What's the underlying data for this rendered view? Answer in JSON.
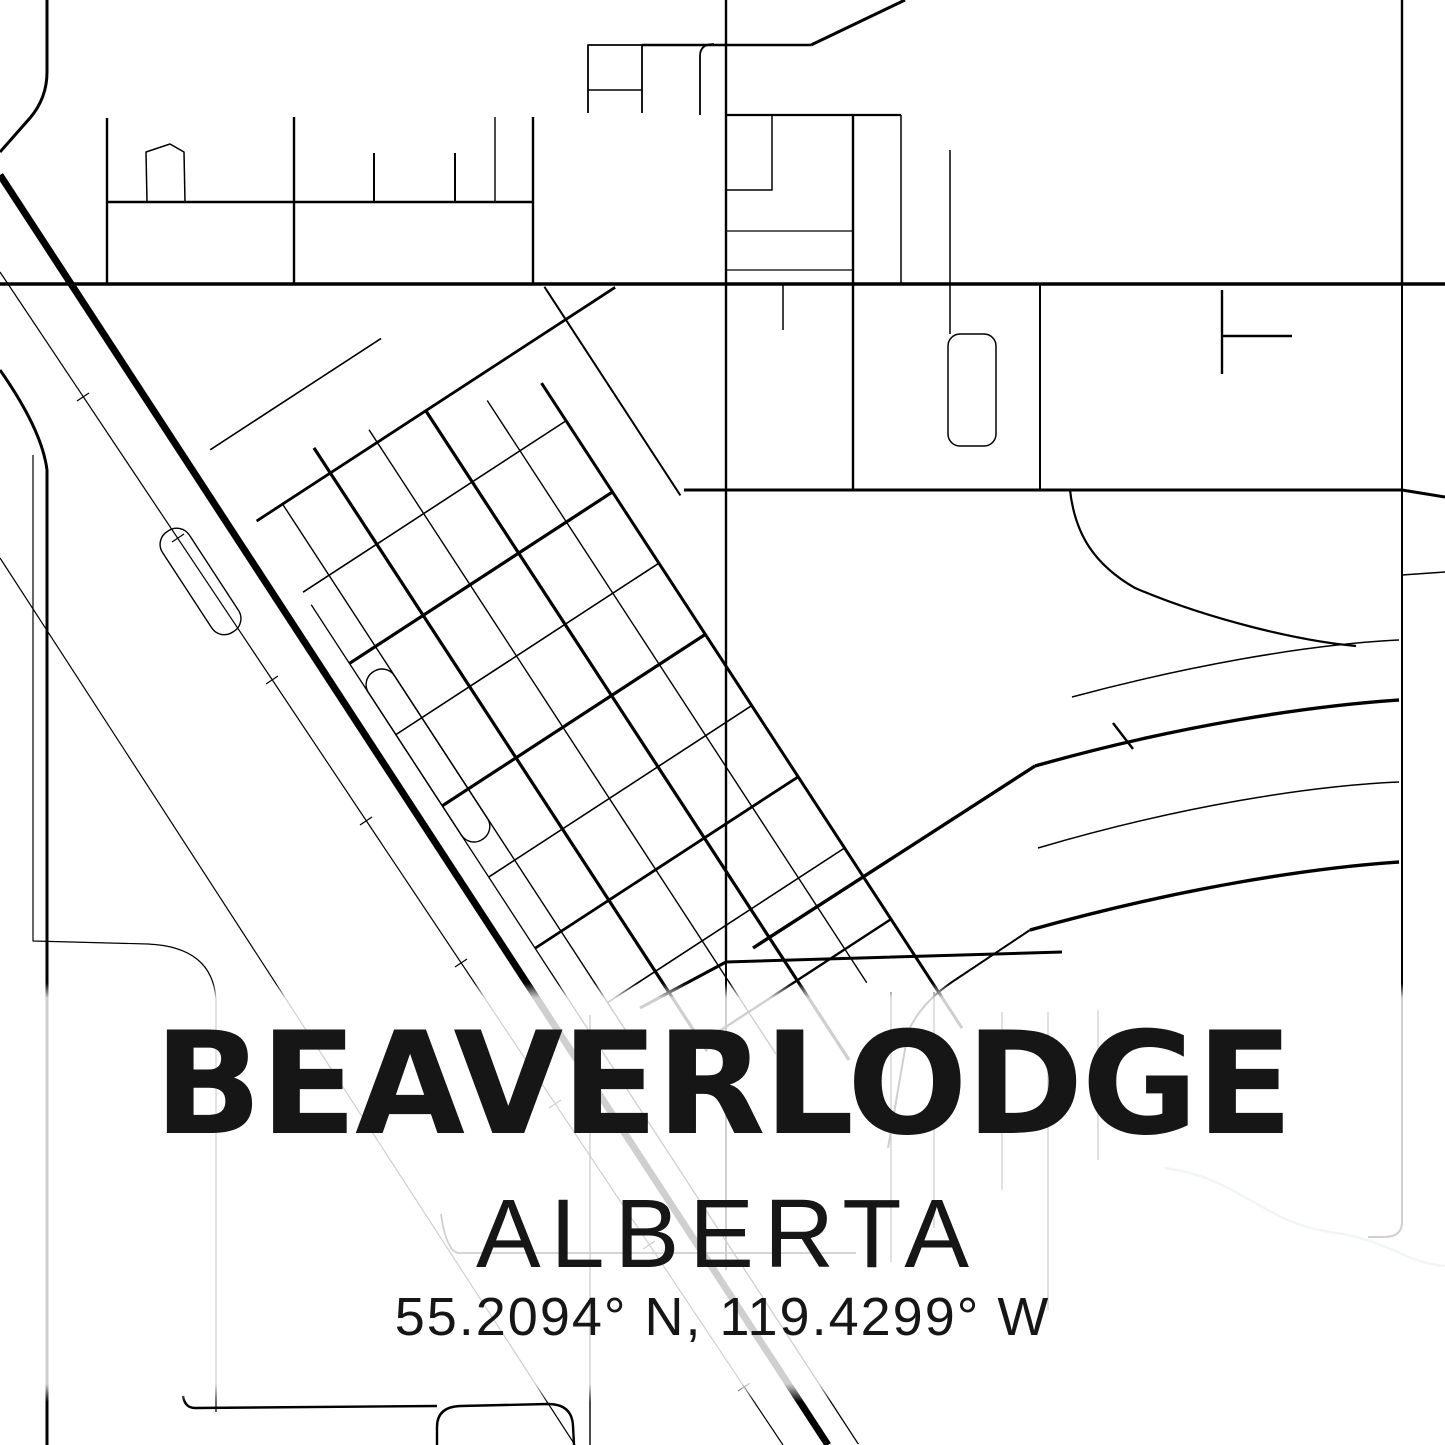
{
  "poster": {
    "title": "BEAVERLODGE",
    "subtitle": "ALBERTA",
    "coordinates": "55.2094° N, 119.4299° W",
    "colors": {
      "background": "#ffffff",
      "road": "#000000",
      "text": "#161616",
      "water": "#b0cdd6"
    }
  }
}
